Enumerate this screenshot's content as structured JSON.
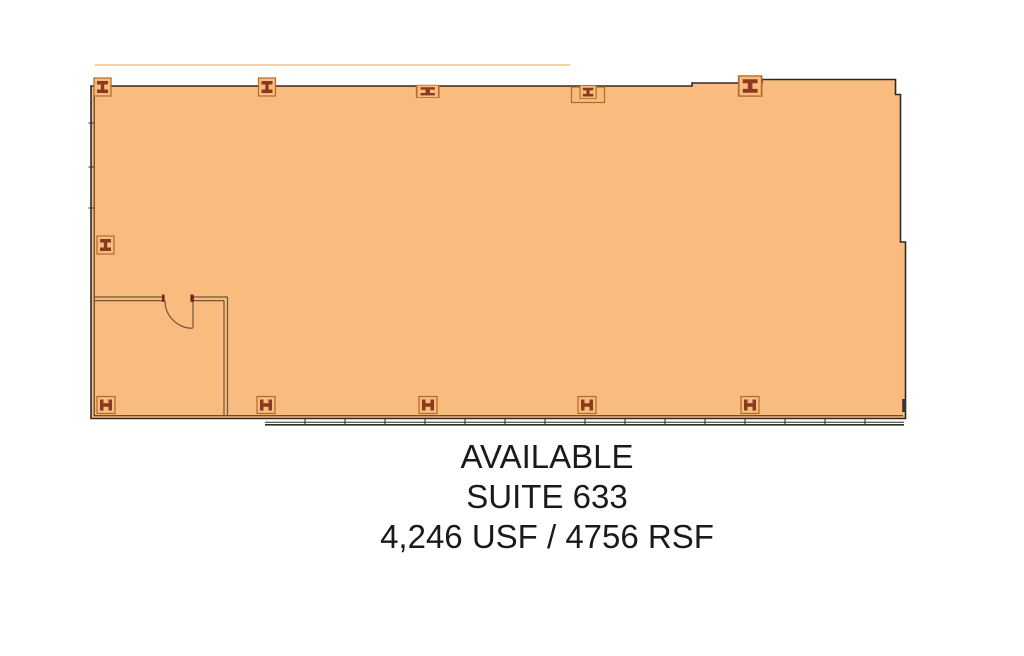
{
  "colors": {
    "background": "#ffffff",
    "plan_fill": "#F9BC7E",
    "wall": "#2E2A26",
    "interior_wall": "#6E553C",
    "symbol_box": "#B06A28",
    "symbol_glyph": "#8C3A1F",
    "faint_line": "#F3D2A4",
    "mullion": "#3A362F",
    "door_mark": "#7A1F14",
    "text": "#1A1A1A"
  },
  "label": {
    "availability": "AVAILABLE",
    "suite": "SUITE 633",
    "area": "4,246 USF / 4756 RSF"
  }
}
